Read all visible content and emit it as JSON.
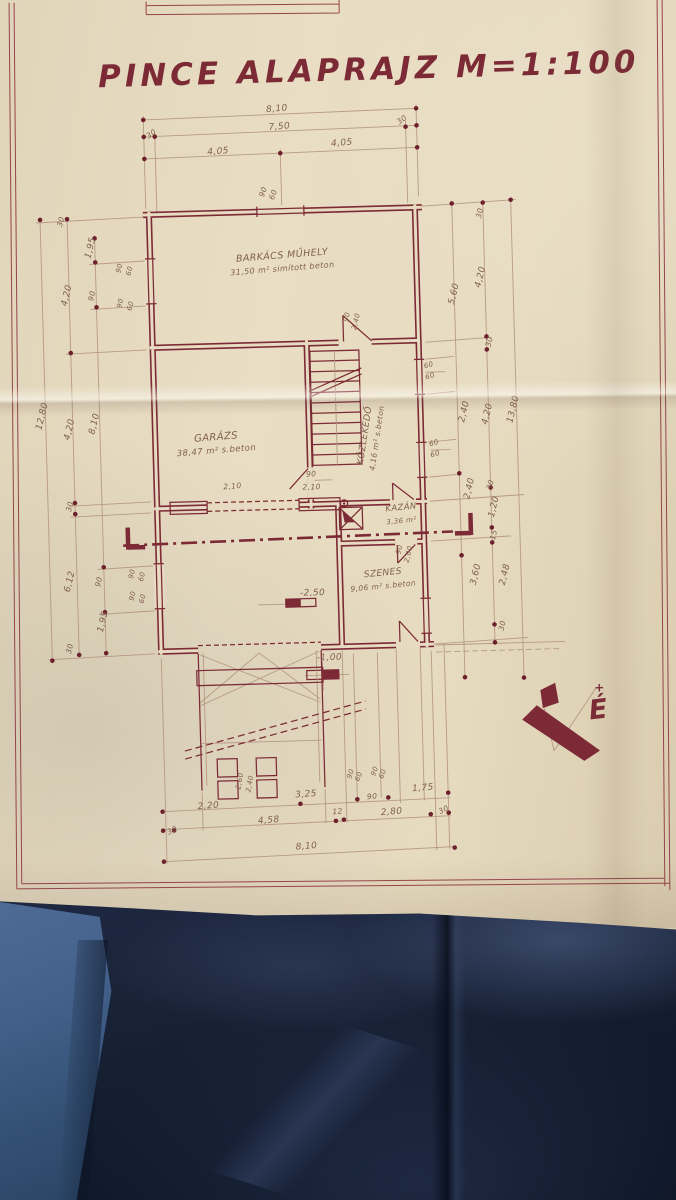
{
  "title": {
    "text": "PINCE ALAPRAJZ M=1:100"
  },
  "north_label": "É",
  "north_plus": "+",
  "colors": {
    "ink": "#7c2a35",
    "papermid": "#e7dbc2",
    "pencil": "#b2947e",
    "hand": "#80604f",
    "fabric": "#182236",
    "denim": "#42608a"
  },
  "plan": {
    "rooms": [
      {
        "name": "BARKÁCS MŰHELY",
        "info": "31,50 m² simított beton",
        "x": 287,
        "y": 258,
        "r": -3,
        "s": 9.5
      },
      {
        "name": "GARÁZS",
        "info": "38,47 m² s.beton",
        "x": 216,
        "y": 438,
        "r": -3,
        "s": 10
      },
      {
        "name": "KÖZLEKEDŐ",
        "info": "4,16 m² s.beton",
        "x": 367,
        "y": 438,
        "r": -80,
        "s": 9,
        "vert": true
      },
      {
        "name": "KAZÁN",
        "info": "3,36 m²",
        "x": 399,
        "y": 513,
        "r": -4,
        "s": 8.5
      },
      {
        "name": "SZENES",
        "info": "9,06 m² s.beton",
        "x": 379,
        "y": 578,
        "r": -4,
        "s": 9
      }
    ],
    "level_marks": [
      {
        "t": "-2,50",
        "x": 308,
        "y": 596
      },
      {
        "t": "-1,00",
        "x": 323,
        "y": 661
      }
    ],
    "dim_labels": [
      {
        "t": "8,10",
        "x": 286,
        "y": 111,
        "r": -3
      },
      {
        "t": "30",
        "x": 161,
        "y": 132,
        "r": -35,
        "s": 7.5
      },
      {
        "t": "7,50",
        "x": 288,
        "y": 129,
        "r": -3
      },
      {
        "t": "30",
        "x": 412,
        "y": 125,
        "r": -35,
        "s": 7.5
      },
      {
        "t": "4,05",
        "x": 226,
        "y": 152,
        "r": -3
      },
      {
        "t": "4,05",
        "x": 350,
        "y": 147,
        "r": -3
      },
      {
        "t": "90",
        "x": 272,
        "y": 192,
        "r": -70,
        "s": 7.5
      },
      {
        "t": "60",
        "x": 282,
        "y": 195,
        "r": -70,
        "s": 7.5
      },
      {
        "t": "30",
        "x": 69,
        "y": 216,
        "r": -75,
        "s": 7.5
      },
      {
        "t": "1,95",
        "x": 98,
        "y": 243,
        "r": -75
      },
      {
        "t": "4,20",
        "x": 73,
        "y": 290,
        "r": -75
      },
      {
        "t": "90",
        "x": 98,
        "y": 291,
        "r": -75,
        "s": 7.5
      },
      {
        "t": "90",
        "x": 126,
        "y": 264,
        "r": -75,
        "s": 7
      },
      {
        "t": "60",
        "x": 136,
        "y": 267,
        "r": -75,
        "s": 7
      },
      {
        "t": "90",
        "x": 126,
        "y": 299,
        "r": -75,
        "s": 7
      },
      {
        "t": "60",
        "x": 136,
        "y": 302,
        "r": -75,
        "s": 7
      },
      {
        "t": "12,80",
        "x": 45,
        "y": 410,
        "r": -75
      },
      {
        "t": "4,20",
        "x": 72,
        "y": 424,
        "r": -75
      },
      {
        "t": "8,10",
        "x": 97,
        "y": 419,
        "r": -75
      },
      {
        "t": "30",
        "x": 70,
        "y": 501,
        "r": -75,
        "s": 7.5
      },
      {
        "t": "6,12",
        "x": 68,
        "y": 576,
        "r": -75
      },
      {
        "t": "90",
        "x": 97,
        "y": 577,
        "r": -75,
        "s": 7.5
      },
      {
        "t": "1,95",
        "x": 100,
        "y": 617,
        "r": -75
      },
      {
        "t": "30",
        "x": 66,
        "y": 643,
        "r": -75,
        "s": 7.5
      },
      {
        "t": "90",
        "x": 130,
        "y": 570,
        "r": -75,
        "s": 7
      },
      {
        "t": "60",
        "x": 140,
        "y": 573,
        "r": -75,
        "s": 7
      },
      {
        "t": "90",
        "x": 130,
        "y": 592,
        "r": -75,
        "s": 7
      },
      {
        "t": "60",
        "x": 140,
        "y": 595,
        "r": -75,
        "s": 7
      },
      {
        "t": "30",
        "x": 488,
        "y": 219,
        "r": -75,
        "s": 7.5
      },
      {
        "t": "5,60",
        "x": 460,
        "y": 299,
        "r": -75
      },
      {
        "t": "4,20",
        "x": 487,
        "y": 283,
        "r": -75
      },
      {
        "t": "30",
        "x": 494,
        "y": 348,
        "r": -75,
        "s": 7.5
      },
      {
        "t": "2,40",
        "x": 467,
        "y": 417,
        "r": -75
      },
      {
        "t": "4,20",
        "x": 490,
        "y": 420,
        "r": -75
      },
      {
        "t": "13,80",
        "x": 516,
        "y": 416,
        "r": -75
      },
      {
        "t": "2,40",
        "x": 470,
        "y": 494,
        "r": -75
      },
      {
        "t": "30",
        "x": 491,
        "y": 491,
        "r": -75,
        "s": 7.5
      },
      {
        "t": "1,20",
        "x": 494,
        "y": 513,
        "r": -75
      },
      {
        "t": "15",
        "x": 493,
        "y": 541,
        "r": -75,
        "s": 7.5
      },
      {
        "t": "3,60",
        "x": 474,
        "y": 580,
        "r": -75
      },
      {
        "t": "2,48",
        "x": 503,
        "y": 581,
        "r": -75
      },
      {
        "t": "30",
        "x": 499,
        "y": 632,
        "r": -75,
        "s": 7.5
      },
      {
        "t": "60",
        "x": 431,
        "y": 371,
        "r": -15,
        "s": 7
      },
      {
        "t": "60",
        "x": 432,
        "y": 382,
        "r": -15,
        "s": 7
      },
      {
        "t": "60",
        "x": 434,
        "y": 449,
        "r": -15,
        "s": 7
      },
      {
        "t": "60",
        "x": 435,
        "y": 460,
        "r": -15,
        "s": 7
      },
      {
        "t": "90",
        "x": 398,
        "y": 553,
        "r": -75,
        "s": 7
      },
      {
        "t": "2,00",
        "x": 407,
        "y": 558,
        "r": -75,
        "s": 7
      },
      {
        "t": "90",
        "x": 352,
        "y": 319,
        "r": -75,
        "s": 7
      },
      {
        "t": "2,40",
        "x": 361,
        "y": 324,
        "r": -75,
        "s": 7
      },
      {
        "t": "90",
        "x": 310,
        "y": 477,
        "s": 7.5
      },
      {
        "t": "2,10",
        "x": 310,
        "y": 490,
        "s": 7.5
      },
      {
        "t": "2,10",
        "x": 231,
        "y": 487,
        "r": -3,
        "s": 7.5
      },
      {
        "t": "2,20",
        "x": 198,
        "y": 806,
        "r": -3
      },
      {
        "t": "3,25",
        "x": 296,
        "y": 797,
        "r": -3
      },
      {
        "t": "90",
        "x": 362,
        "y": 801,
        "r": -3,
        "s": 7.5
      },
      {
        "t": "1,75",
        "x": 413,
        "y": 794,
        "r": -3
      },
      {
        "t": "30",
        "x": 162,
        "y": 829,
        "r": -25,
        "s": 7.5
      },
      {
        "t": "4,58",
        "x": 258,
        "y": 822,
        "r": -3
      },
      {
        "t": "12",
        "x": 327,
        "y": 815,
        "r": -3,
        "s": 7.5
      },
      {
        "t": "2,80",
        "x": 381,
        "y": 817,
        "r": -3
      },
      {
        "t": "30",
        "x": 434,
        "y": 816,
        "r": -25,
        "s": 7.5
      },
      {
        "t": "8,10",
        "x": 295,
        "y": 849,
        "r": -3
      },
      {
        "t": "2,60",
        "x": 232,
        "y": 780,
        "r": -78,
        "s": 7
      },
      {
        "t": "2,40",
        "x": 242,
        "y": 783,
        "r": -78,
        "s": 7
      },
      {
        "t": "90",
        "x": 343,
        "y": 776,
        "r": -70,
        "s": 7
      },
      {
        "t": "60",
        "x": 351,
        "y": 779,
        "r": -70,
        "s": 7
      },
      {
        "t": "90",
        "x": 367,
        "y": 774,
        "r": -70,
        "s": 7
      },
      {
        "t": "60",
        "x": 375,
        "y": 777,
        "r": -70,
        "s": 7
      }
    ]
  }
}
